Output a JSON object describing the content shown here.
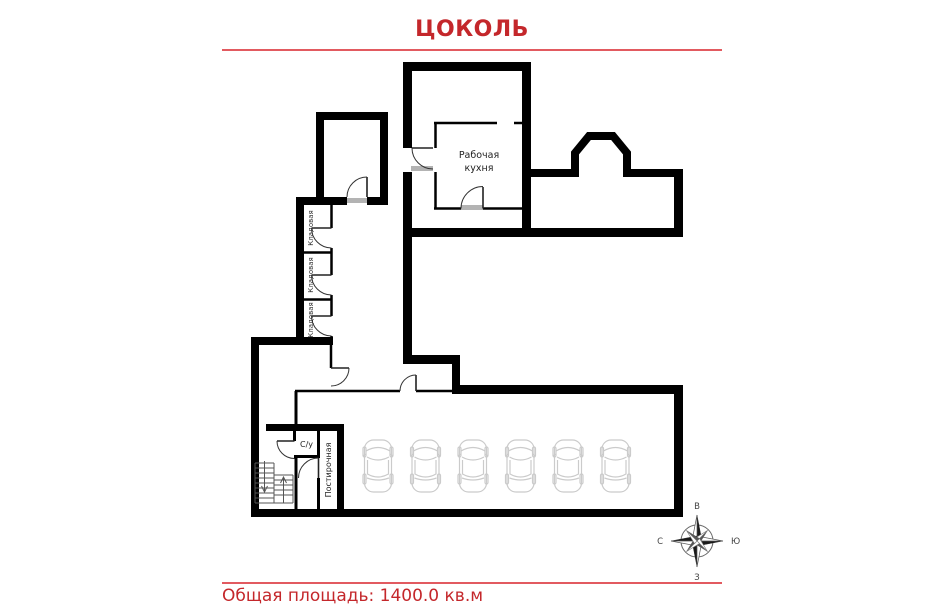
{
  "header": {
    "title": "ЦОКОЛЬ"
  },
  "footer": {
    "total_area": "Общая площадь: 1400.0 кв.м"
  },
  "plan": {
    "rooms": {
      "kitchen": {
        "label_line1": "Рабочая",
        "label_line2": "кухня"
      },
      "storage_1": {
        "label": "Кладовая"
      },
      "storage_2": {
        "label": "Кладовая"
      },
      "storage_3": {
        "label": "Кладовая"
      },
      "bathroom": {
        "label": "С/у"
      },
      "laundry": {
        "label": "Постирочная"
      }
    },
    "garage": {
      "car_count": 6,
      "car_centers_x": [
        378,
        425.5,
        473,
        520.5,
        568,
        615.5
      ],
      "car_top_y": 434
    }
  },
  "compass": {
    "top": "В",
    "right": "Ю",
    "bottom": "З",
    "left": "С"
  },
  "colors": {
    "accent_red": "#c4272b",
    "rule_red": "#e25a60",
    "wall_black": "#000000",
    "car_gray": "#cbcbcb"
  }
}
